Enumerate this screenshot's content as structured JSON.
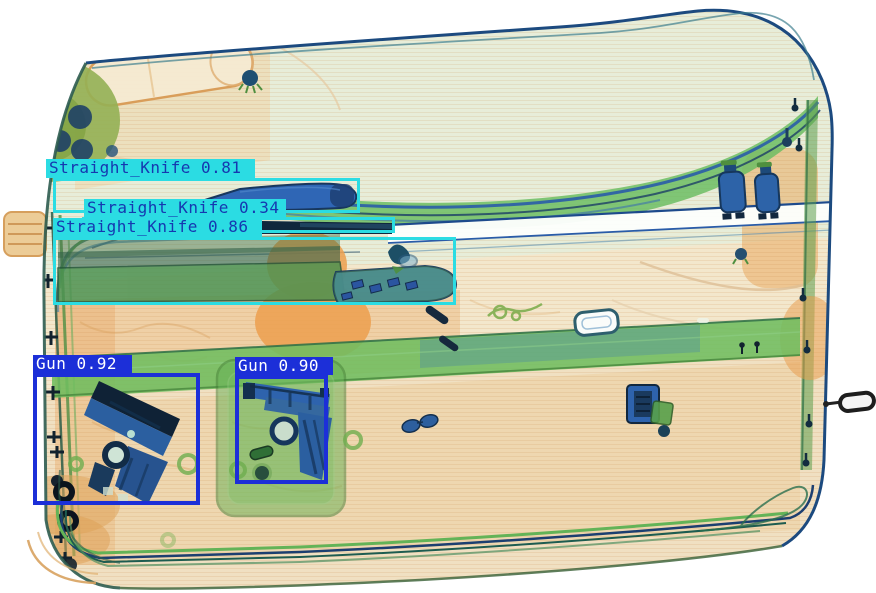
{
  "scene": {
    "description": "X-ray security scan of a suitcase containing detected threat objects",
    "image_width": 876,
    "image_height": 593,
    "background_color": "#ffffff"
  },
  "palette": {
    "knife_box_color": "#2bdce3",
    "knife_text_color": "#1638b0",
    "gun_box_color": "#1c2fd8",
    "gun_text_color": "#ffffff",
    "xray_organic_orange": "#eca055",
    "xray_plastic_green": "#6fbd60",
    "xray_metal_blue": "#2b5fa0",
    "xray_background_cream": "#f1e9d6"
  },
  "detections": [
    {
      "id": "straight-knife-081",
      "label": "Straight_Knife",
      "score": "0.81",
      "text": "Straight_Knife 0.81",
      "box_color": "#2bdce3",
      "label_bg": "#2bdce3",
      "text_color": "#1638b0",
      "border_width": 3,
      "bbox": {
        "x": 53,
        "y": 178,
        "w": 307,
        "h": 35
      },
      "label_box": {
        "x": 46,
        "y": 159,
        "w": 209,
        "h": 19
      }
    },
    {
      "id": "straight-knife-034",
      "label": "Straight_Knife",
      "score": "0.34",
      "text": "Straight_Knife 0.34",
      "box_color": "#2bdce3",
      "label_bg": "#2bdce3",
      "text_color": "#1638b0",
      "border_width": 3,
      "bbox": {
        "x": 82,
        "y": 217,
        "w": 313,
        "h": 16
      },
      "label_box": {
        "x": 84,
        "y": 199,
        "w": 202,
        "h": 18
      }
    },
    {
      "id": "straight-knife-086",
      "label": "Straight_Knife",
      "score": "0.86",
      "text": "Straight_Knife 0.86",
      "box_color": "#2bdce3",
      "label_bg": "#2bdce3",
      "text_color": "#1638b0",
      "border_width": 3,
      "bbox": {
        "x": 53,
        "y": 237,
        "w": 403,
        "h": 68
      },
      "label_box": {
        "x": 53,
        "y": 218,
        "w": 209,
        "h": 19
      }
    },
    {
      "id": "gun-092",
      "label": "Gun",
      "score": "0.92",
      "text": "Gun 0.92",
      "box_color": "#1c2fd8",
      "label_bg": "#1c2fd8",
      "text_color": "#ffffff",
      "border_width": 4,
      "bbox": {
        "x": 33,
        "y": 373,
        "w": 167,
        "h": 132
      },
      "label_box": {
        "x": 33,
        "y": 355,
        "w": 99,
        "h": 18
      }
    },
    {
      "id": "gun-090",
      "label": "Gun",
      "score": "0.90",
      "text": "Gun 0.90",
      "box_color": "#1c2fd8",
      "label_bg": "#1c2fd8",
      "text_color": "#ffffff",
      "border_width": 4,
      "bbox": {
        "x": 235,
        "y": 375,
        "w": 93,
        "h": 109
      },
      "label_box": {
        "x": 235,
        "y": 357,
        "w": 98,
        "h": 18
      }
    }
  ]
}
